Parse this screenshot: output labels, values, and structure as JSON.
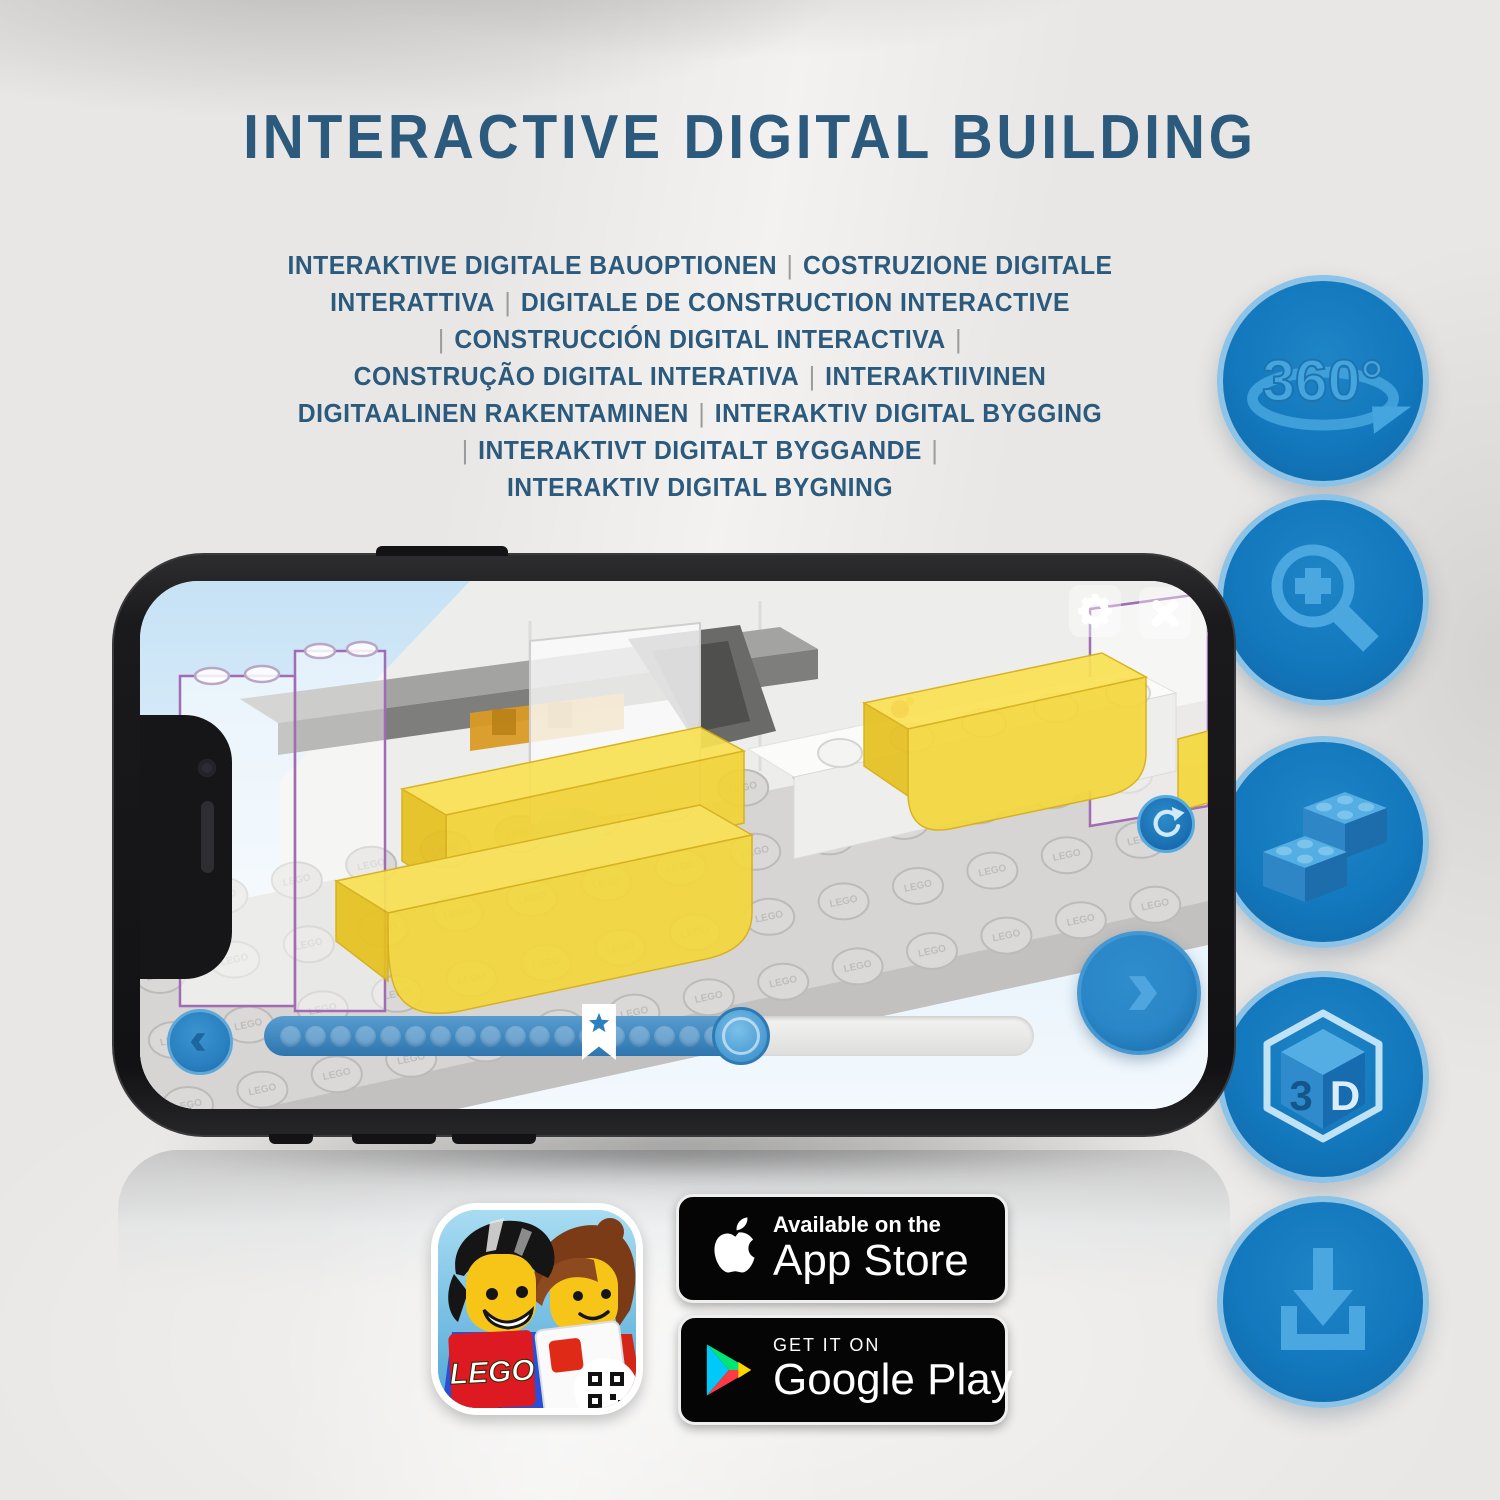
{
  "header": {
    "title": "INTERACTIVE DIGITAL BUILDING"
  },
  "subtitle": {
    "lines": [
      "INTERAKTIVE DIGITALE BAUOPTIONEN | COSTRUZIONE DIGITALE",
      "INTERATTIVA | DIGITALE DE CONSTRUCTION INTERACTIVE",
      "| CONSTRUCCIÓN DIGITAL INTERACTIVA |",
      "CONSTRUÇÃO DIGITAL INTERATIVA | INTERAKTIIVINEN",
      "DIGITAALINEN RAKENTAMINEN | INTERAKTIV DIGITAL BYGGING",
      "| INTERAKTIVT DIGITALT BYGGANDE |",
      "INTERAKTIV DIGITAL BYGNING"
    ]
  },
  "features": {
    "rotation_label": "360°",
    "cube_left": "3",
    "cube_right": "D"
  },
  "phone": {
    "progress": {
      "dots_in_fill": 18,
      "fill_percent": 62,
      "star_percent": 43.5
    },
    "scene": {
      "stud_rows": 4,
      "stud_cols": 14,
      "stud_embossing": "LEGO"
    }
  },
  "badges": {
    "app_store": {
      "line1": "Available on the",
      "line2": "App Store"
    },
    "google_play": {
      "line1": "GET IT ON",
      "line2": "Google Play"
    },
    "app_icon": {
      "logo_text": "LEGO"
    }
  },
  "colors": {
    "title_blue": "#2b5a7d",
    "pipe_grey": "#9b9b9b",
    "circle_blue": "#1378bd",
    "circle_ring": "#8cc3e6",
    "glyph_blue": "#4aa7e0",
    "glyph_light": "#bfe2f6",
    "screen_sky": "#cfe7f7",
    "brick_yellow": "#f5d93f",
    "plate_grey": "#d9d8d6",
    "bar_blue": "#3e88c0",
    "button_blue": "#2a86c8",
    "badge_black": "#050505",
    "lego_red": "#dd1a22"
  }
}
